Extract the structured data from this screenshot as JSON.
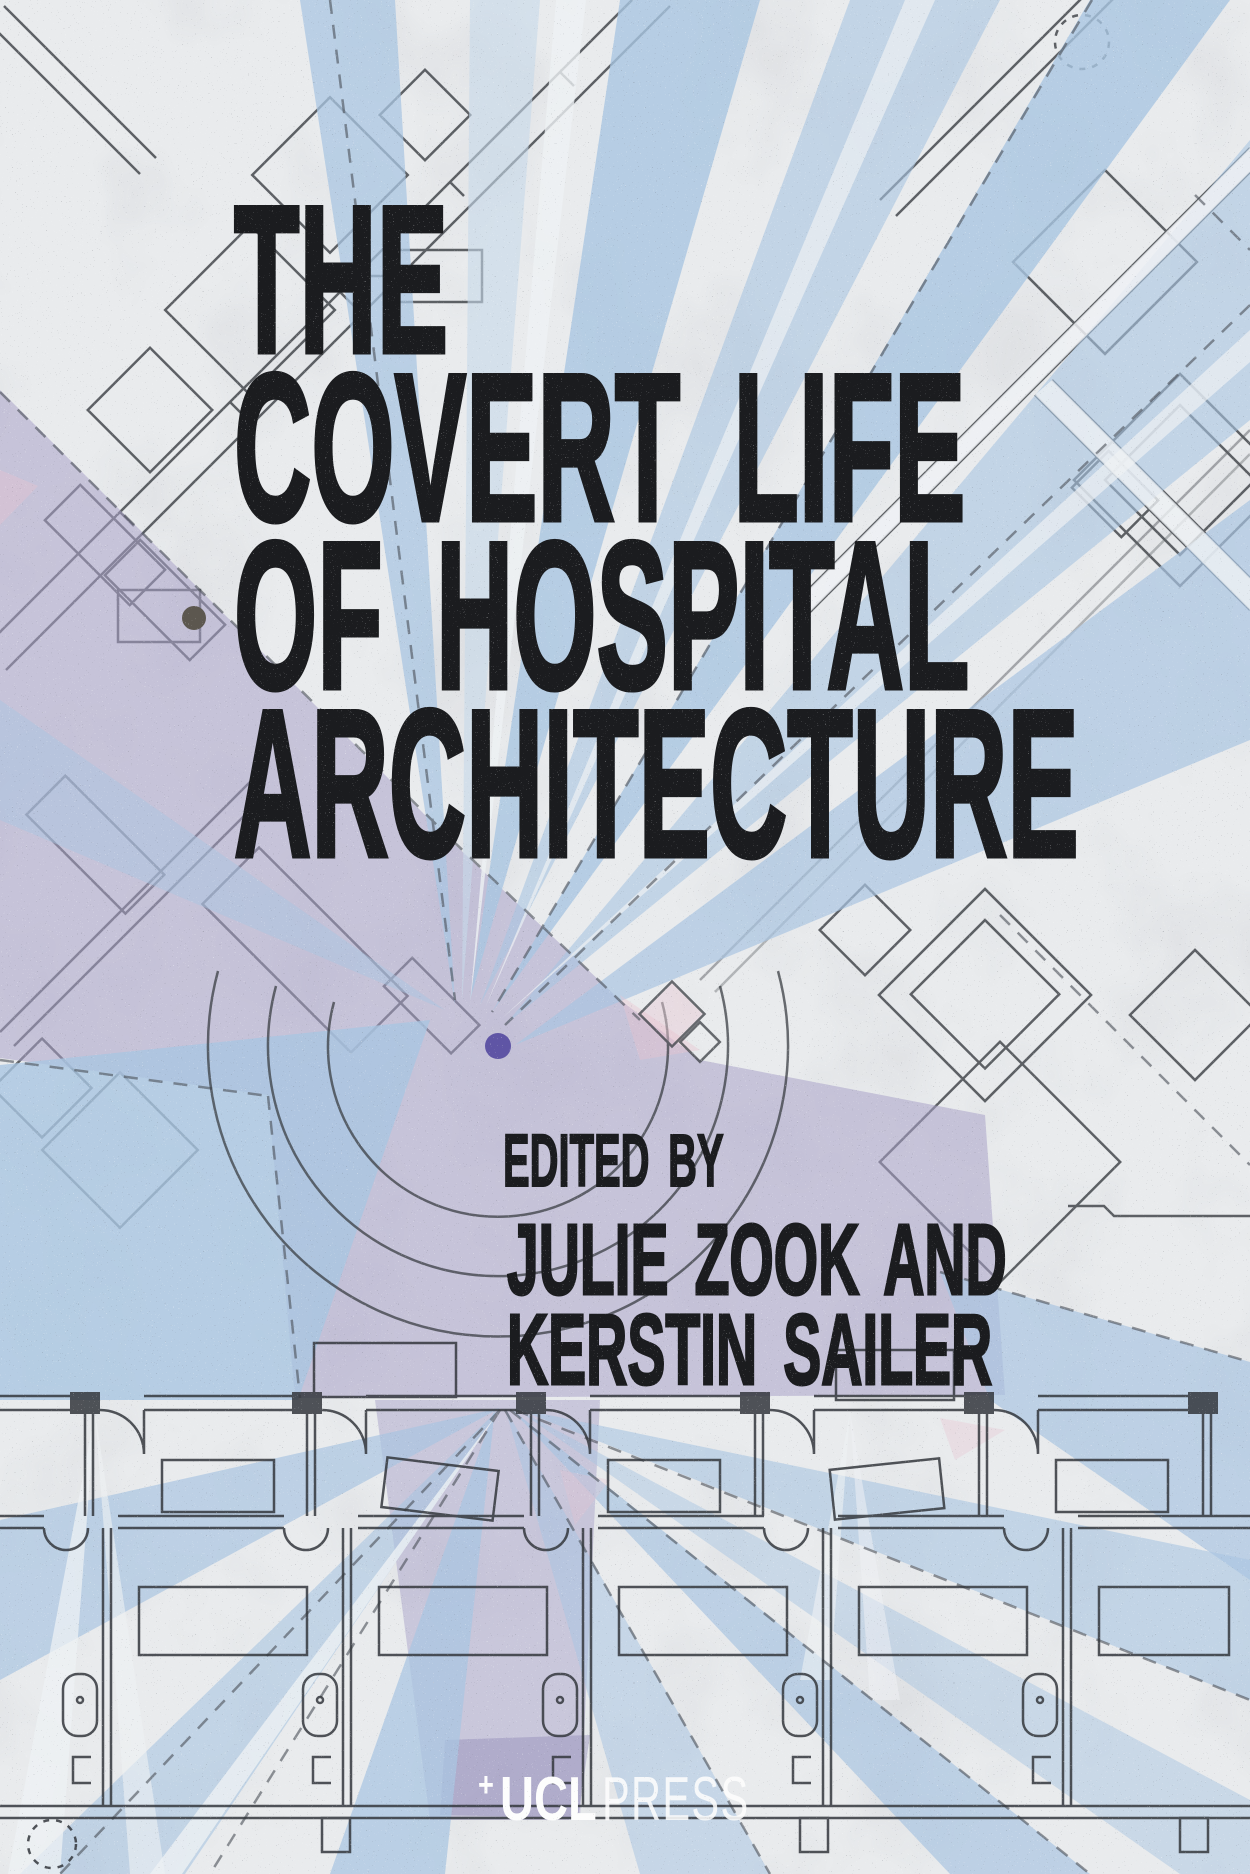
{
  "book_cover": {
    "title": {
      "lines": [
        "THE",
        "COVERT LIFE",
        "OF HOSPITAL",
        "ARCHITECTURE"
      ]
    },
    "editors": {
      "label": "EDITED BY",
      "names": [
        "JULIE ZOOK AND",
        "KERSTIN SAILER"
      ]
    },
    "publisher": {
      "plus_mark": "+",
      "name": "UCL",
      "imprint": "PRESS"
    },
    "artwork": {
      "colors": {
        "paper": "#e9ebed",
        "ink": "#1b1c1f",
        "plan_line": "#3a3e43",
        "wedge_blue": "#a9c5e1",
        "wedge_blue_light": "#c6d8ea",
        "wedge_white": "#eef1f4",
        "cone_lavender": "#aaa3c9",
        "cone_lavender_deep": "#8d85b5",
        "accent_pink": "#e8c3d0",
        "dot_gray": "#5c574f",
        "dot_purple": "#5f55a5",
        "logo_white": "#fdfdfd"
      }
    }
  }
}
